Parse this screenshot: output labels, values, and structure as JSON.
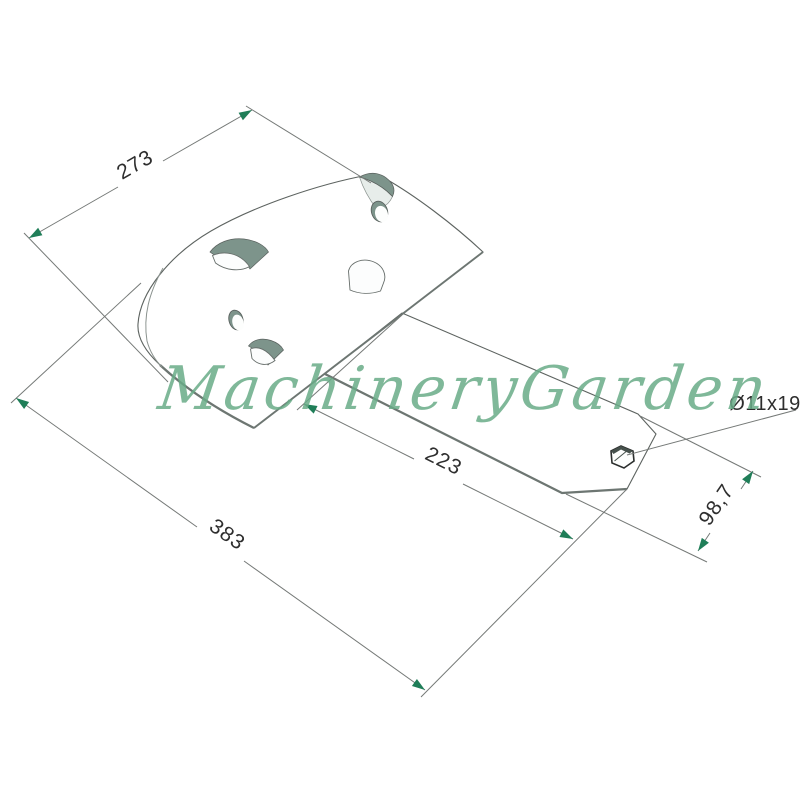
{
  "watermark": {
    "text": "MachineryGarden",
    "color": "#69ab87"
  },
  "dimensions": {
    "blade_width": "273",
    "plate_length": "223",
    "overall_length": "383",
    "plate_width": "98,7"
  },
  "callout": {
    "hole_spec": "Ø11x19"
  },
  "colors": {
    "background": "#ffffff",
    "arrow": "#1f7e58",
    "dim_line": "#757977",
    "dim_text": "#2e2e2e",
    "part_fill": "#f3f6f5",
    "part_outline": "#5d6360",
    "slot_shading": "#7d948b",
    "watermark_green": "#69ab87"
  }
}
